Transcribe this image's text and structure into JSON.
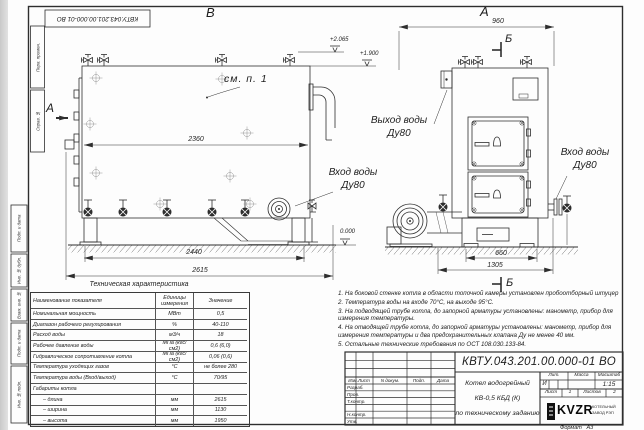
{
  "sheet": {
    "stamp_top": "КВТУ.043.201.00.000-01 ВО",
    "format_label": "Формат",
    "format_value": "А3"
  },
  "margin_fields": {
    "perv_primen": "Перв. примен.",
    "sprav_no": "Справ. №",
    "podp_data_1": "Подп. и дата",
    "inv_dubl": "Инв. № дубл.",
    "vzam_inv": "Взам. инв. №",
    "podp_data_2": "Подп. и дата",
    "inv_podl": "Инв. № подл."
  },
  "front_view": {
    "label": "В",
    "section_mark": "А",
    "see_note": "см. п. 1",
    "dim_width": "2360",
    "dim_base": "2440",
    "dim_overall": "2615",
    "elev_top": "+2.065",
    "elev_mid": "+1.900",
    "elev_zero": "0.000",
    "inlet_line1": "Вход воды",
    "inlet_line2": "Ду80"
  },
  "side_view": {
    "label": "А",
    "section_top": "Б",
    "section_bottom": "Б",
    "dim_width": "960",
    "dim_base": "660",
    "dim_overall": "1305",
    "outlet_line1": "Выход воды",
    "outlet_line2": "Ду80",
    "inlet_line1": "Вход воды",
    "inlet_line2": "Ду80"
  },
  "spec_table": {
    "title": "Техническая характеристика",
    "headers": {
      "name": "Наименование показателя",
      "unit": "Единицы измерения",
      "value": "Значение"
    },
    "rows": [
      {
        "name": "Номинальная мощность",
        "unit": "МВт",
        "value": "0,5"
      },
      {
        "name": "Диапазон рабочего регулирования",
        "unit": "%",
        "value": "40-110"
      },
      {
        "name": "Расход воды",
        "unit": "м3/ч",
        "value": "18"
      },
      {
        "name": "Рабочее давление воды",
        "unit": "МПа (кгс/см2)",
        "value": "0,6 (6,0)"
      },
      {
        "name": "Гидравлическое сопротивление котла",
        "unit": "МПа (кгс/см2)",
        "value": "0,06 (0,6)"
      },
      {
        "name": "Температура уходящих газов",
        "unit": "°С",
        "value": "не более 280"
      },
      {
        "name": "Температура воды (Вход/выход)",
        "unit": "°С",
        "value": "70/95"
      },
      {
        "name": "Габариты котла",
        "unit": "",
        "value": ""
      },
      {
        "name": "– длина",
        "unit": "мм",
        "value": "2615"
      },
      {
        "name": "– ширина",
        "unit": "мм",
        "value": "1130"
      },
      {
        "name": "– высота",
        "unit": "мм",
        "value": "1950"
      }
    ]
  },
  "notes": [
    "1. На боковой стенке котла в области топочной камеры установлен пробоотборный штуцер",
    "2. Температура воды на входе 70°С, на выходе 95°С.",
    "3. На подводящей трубе котла, до запорной арматуры установлены: манометр, прибор для измерения температуры.",
    "4. На отводящей трубе котла, до запорной арматуры установлены: манометр, прибор для измерения температуры и два предохранительных клапана Ду не менее 40 мм.",
    "5. Остальные технические требования по ОСТ 108.030.133-84."
  ],
  "title_block": {
    "doc_number": "КВТУ.043.201.00.000-01 ВО",
    "product_line1": "Котел водогрейный",
    "product_line2": "КВ-0,5 КБД (К)",
    "product_line3": "по техническому заданию",
    "col_izm": "Изм.Лист",
    "col_doc": "N докум.",
    "col_sign": "Подп.",
    "col_date": "Дата",
    "row_razrab": "Разраб.",
    "row_prov": "Пров.",
    "row_tkontr": "Т.контр.",
    "row_nkontr": "Н.контр.",
    "row_utv": "Утв.",
    "lit_label": "Лит.",
    "mass_label": "Масса",
    "scale_label": "Масштаб",
    "lit_value": "И",
    "scale_value": "1:15",
    "sheet_label": "Лист",
    "sheet_value": "1",
    "sheets_label": "Листов",
    "sheets_value": "2",
    "logo_text": "KVZR",
    "logo_line1": "КОТЕЛЬНЫЙ",
    "logo_line2": "ЗАВОД РЭП"
  }
}
